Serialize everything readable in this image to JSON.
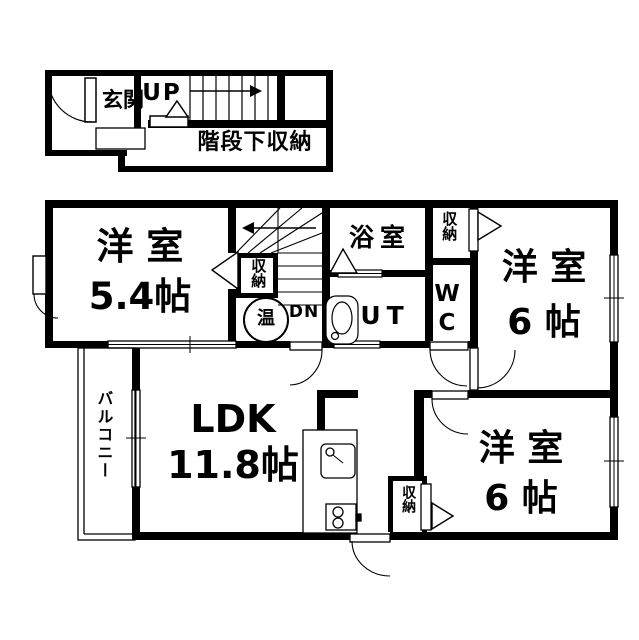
{
  "colors": {
    "wall": "#000000",
    "background": "#ffffff",
    "line": "#000000"
  },
  "first_floor": {
    "entrance": "玄関",
    "stairs_up": "UP",
    "under_stairs_storage": "階段下収納"
  },
  "second_floor": {
    "bedroom_west": "洋 室\n5.4帖",
    "stair_closet": "収納",
    "water_heater": "温",
    "stairs_down": "DN",
    "bathroom": "浴室",
    "closet_north": "収納",
    "bedroom_east_north": "洋 室\n6 帖",
    "toilet": "W\nC",
    "utility": "UT",
    "ldk": "LDK\n11.8帖",
    "balcony": "バルコニー",
    "bedroom_east_south": "洋 室\n6 帖",
    "closet_south": "収納"
  }
}
